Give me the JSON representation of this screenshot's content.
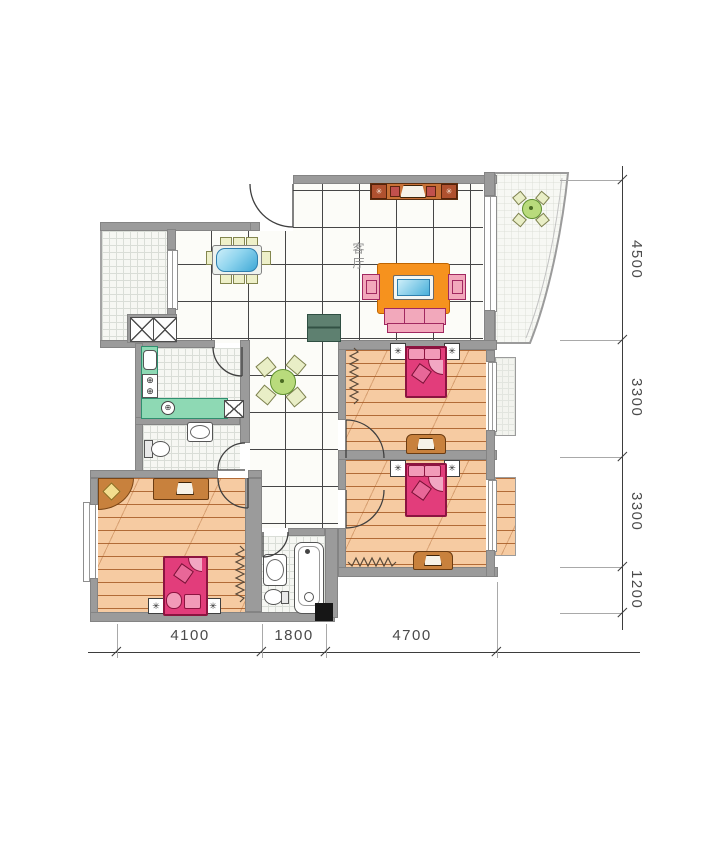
{
  "plan": {
    "living_room_label": "客厅",
    "dims_right": [
      "4500",
      "3300",
      "3300",
      "1200"
    ],
    "dims_bottom": [
      "4100",
      "1800",
      "4700"
    ]
  },
  "icons": {
    "star": "✳",
    "burner": "⊕"
  },
  "colors": {
    "wall": "#9b9b9b",
    "wood_floor": "#f6cba2",
    "bed": "#e23d7b",
    "sofa_orange": "#f6921e",
    "armchair_pink": "#f2a8bb",
    "counter_green": "#8ed9b4",
    "table_blue": "#6fc8e8",
    "cabinet_brown": "#c8813d",
    "dimension_text": "#4a4a4a"
  }
}
